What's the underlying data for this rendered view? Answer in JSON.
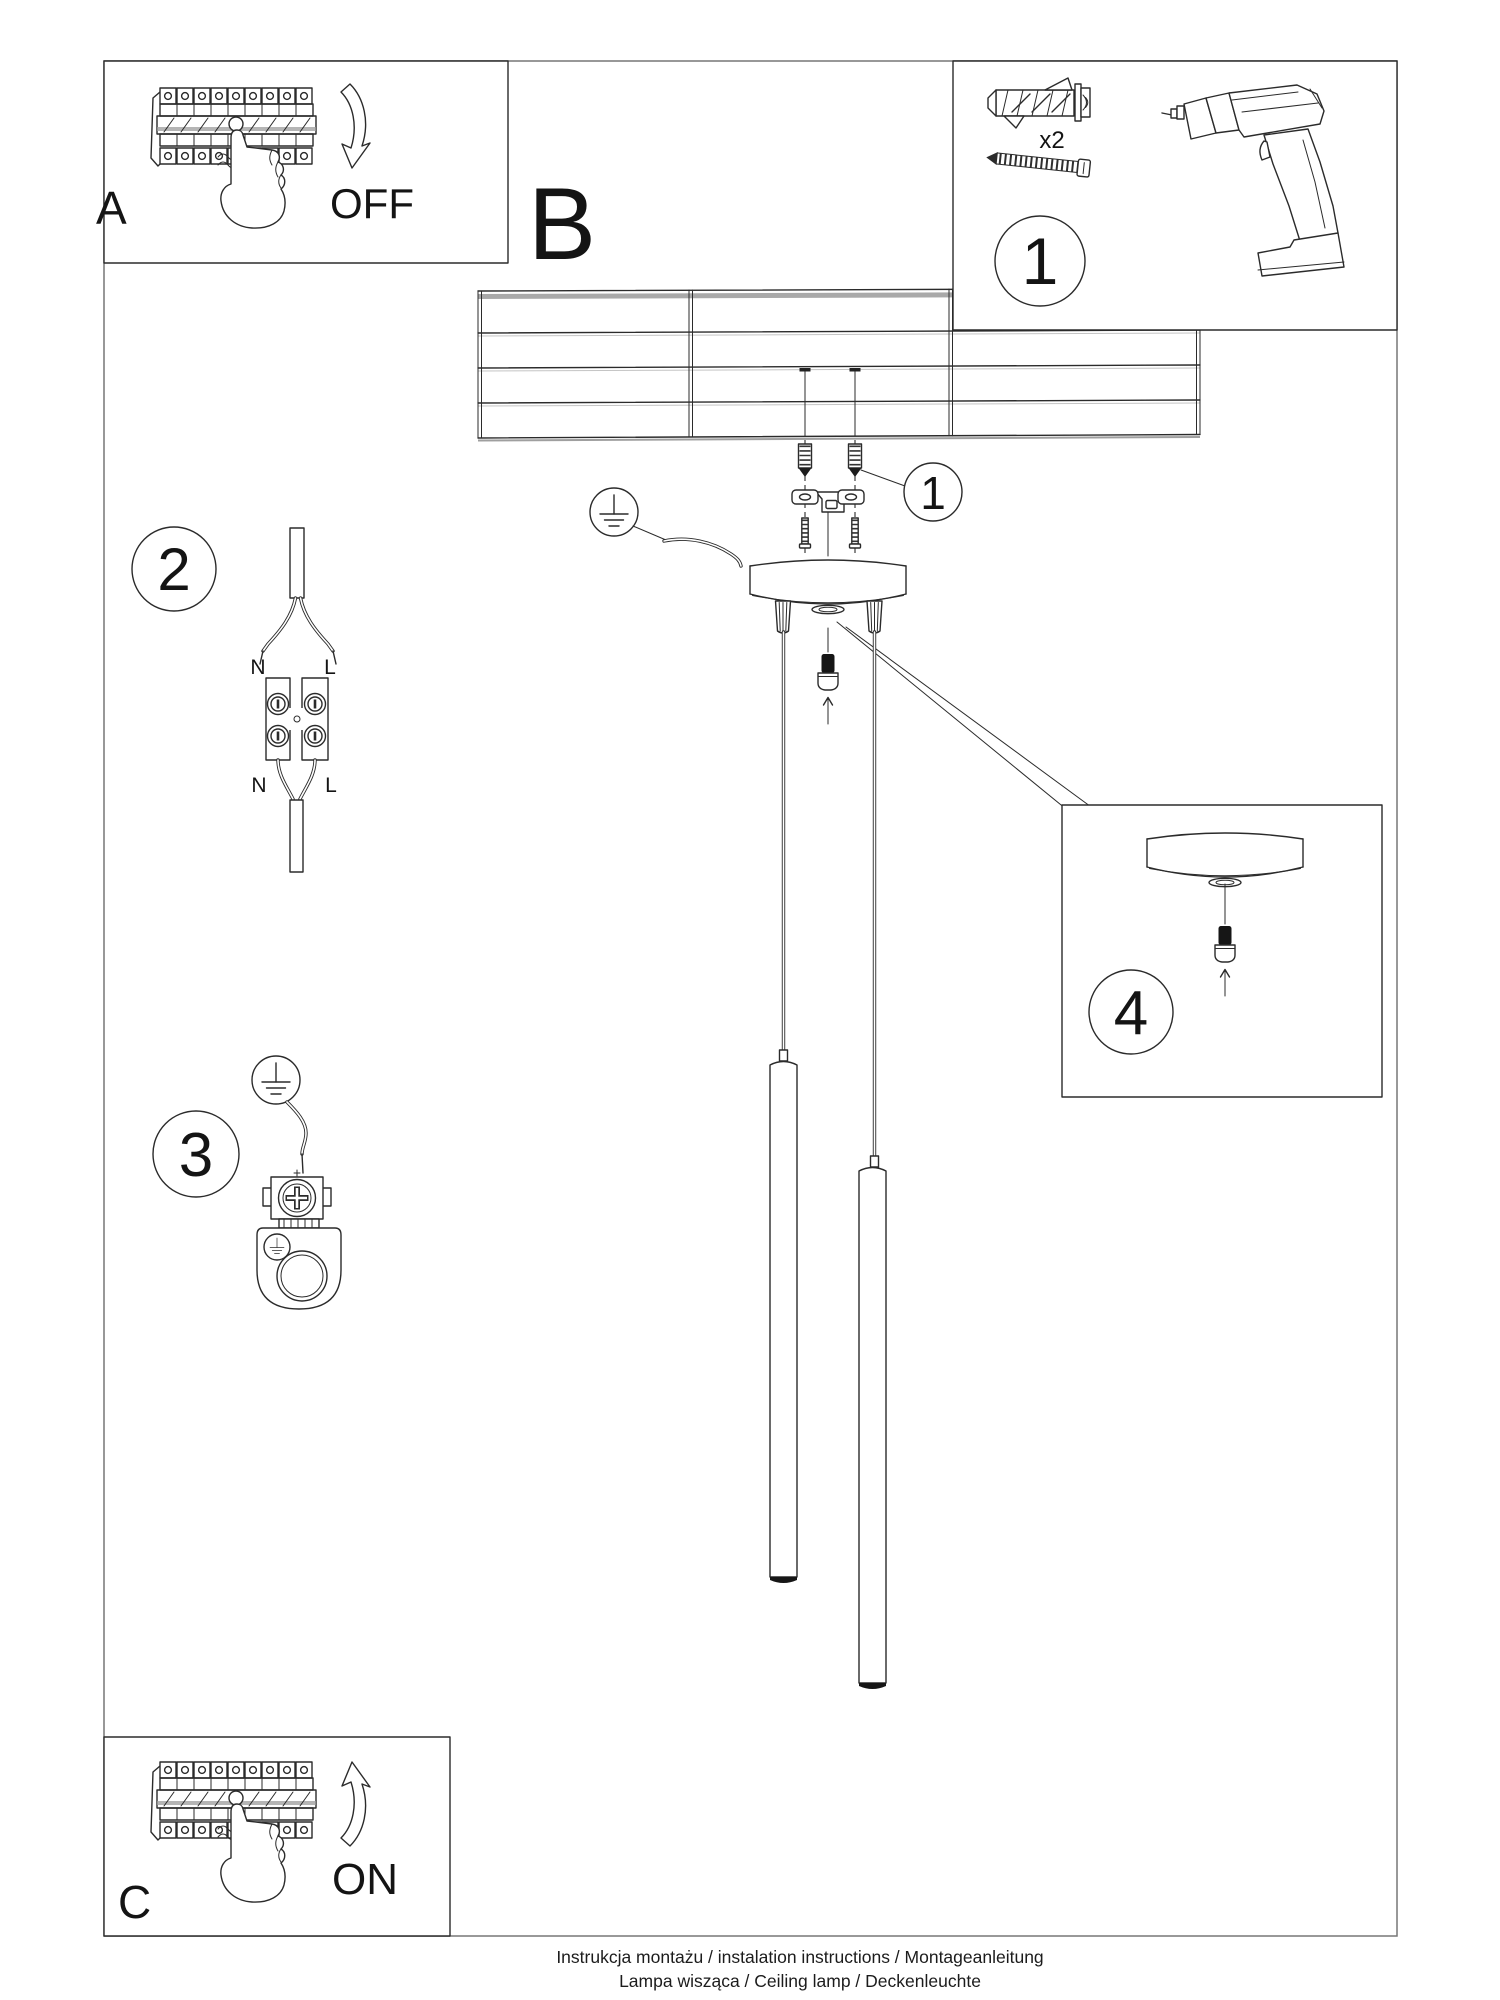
{
  "steps": {
    "panel_a_label": "A",
    "panel_b_label": "B",
    "panel_c_label": "C",
    "power_off": "OFF",
    "power_on": "ON",
    "step1_number": "1",
    "step1_quantity": "x2",
    "callout1_number": "1",
    "step2_number": "2",
    "step3_number": "3",
    "step4_number": "4"
  },
  "wiring": {
    "top_left": "N",
    "top_right": "L",
    "bottom_left": "N",
    "bottom_right": "L"
  },
  "footer": {
    "line1": "Instrukcja montażu / instalation instructions / Montageanleitung",
    "line2": "Lampa wisząca / Ceiling lamp / Deckenleuchte"
  },
  "colors": {
    "ink": "#2b2b2b",
    "frame": "#777777",
    "shade": "#a9a9a9",
    "background": "#ffffff"
  }
}
